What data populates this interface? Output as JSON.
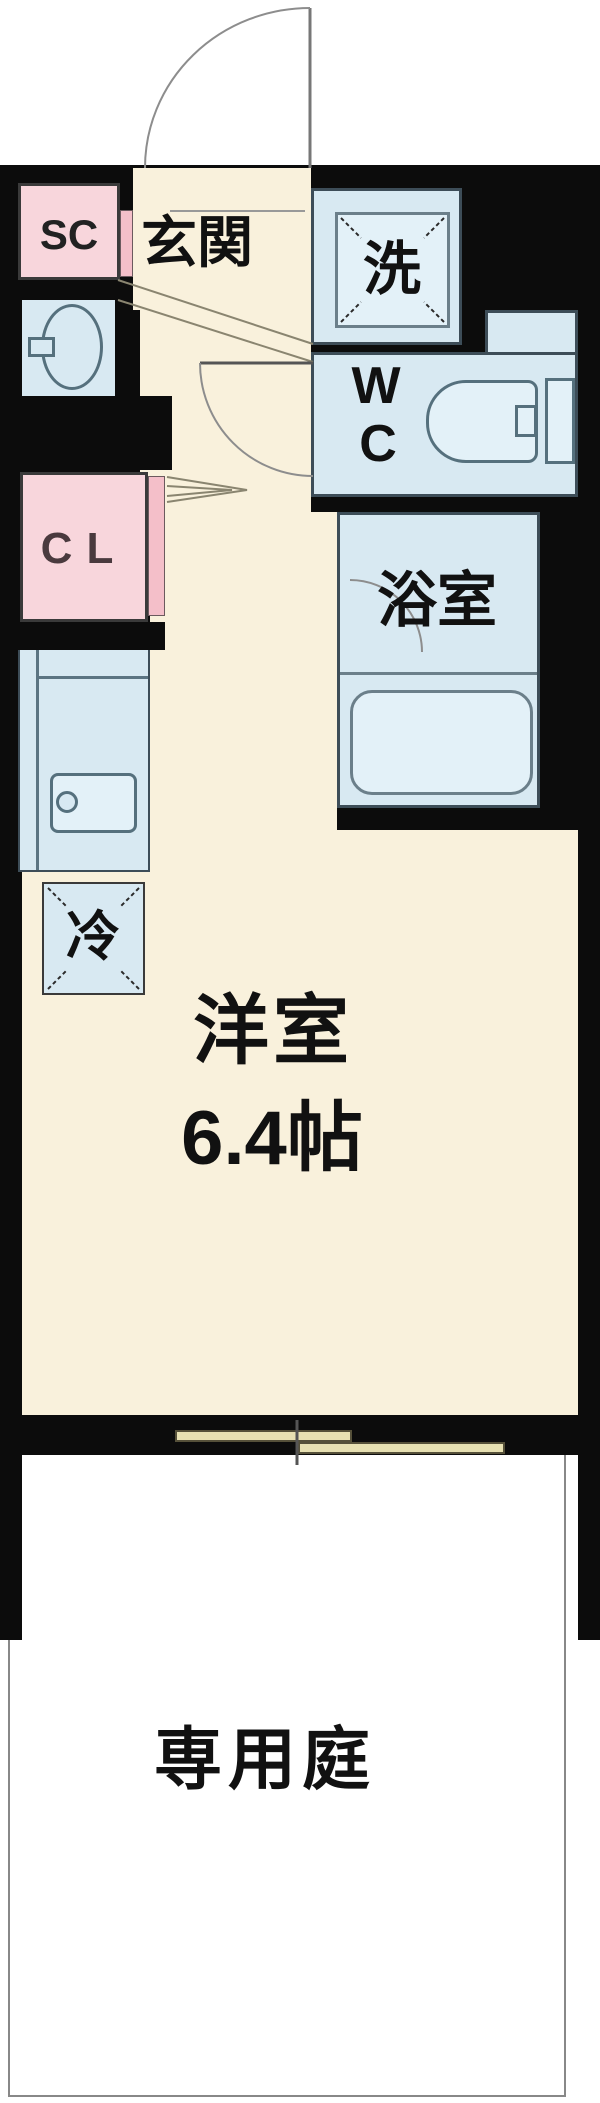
{
  "floorplan": {
    "type": "japanese-apartment-floor-plan",
    "labels": {
      "genkan": "玄関",
      "washer": "洗",
      "wc_w": "W",
      "wc_c": "C",
      "bathroom": "浴室",
      "shoe_closet": "SC",
      "closet": "CL",
      "fridge": "冷",
      "room": "洋室",
      "room_size": "6.4帖",
      "garden": "専用庭"
    },
    "rooms": [
      {
        "id": "genkan",
        "label": "玄関"
      },
      {
        "id": "shoe-closet",
        "label": "SC"
      },
      {
        "id": "washbasin-room",
        "label": ""
      },
      {
        "id": "washer-space",
        "label": "洗"
      },
      {
        "id": "wc",
        "label": "WC"
      },
      {
        "id": "bathroom",
        "label": "浴室"
      },
      {
        "id": "closet",
        "label": "CL"
      },
      {
        "id": "kitchen",
        "label": ""
      },
      {
        "id": "fridge-space",
        "label": "冷"
      },
      {
        "id": "western-room",
        "label": "洋室",
        "size": "6.4帖"
      },
      {
        "id": "private-garden",
        "label": "専用庭"
      }
    ],
    "colors": {
      "wall_black": "#0c0c0c",
      "floor_cream": "#f9f1dc",
      "room_blue": "#d8e9f2",
      "fixture_blue": "#e3f1f8",
      "fixture_border": "#5b7482",
      "closet_pink": "#f8d6dc",
      "closet_door_pink": "#f4bfc9",
      "window_khaki": "#e7e0b2",
      "garden_border": "#888888",
      "door_swing_gray": "#8d8d8d",
      "step_line": "#8a8570"
    }
  }
}
